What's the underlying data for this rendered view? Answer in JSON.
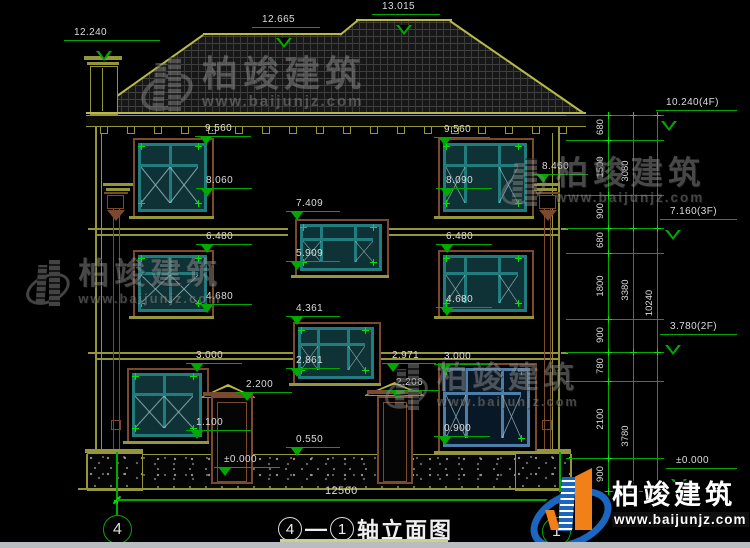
{
  "brand": {
    "name": "柏竣建筑",
    "url": "www.baijunjz.com"
  },
  "colors": {
    "green": "#00a800",
    "bright_green": "#00e400",
    "olive": "#95953a",
    "roof_line": "#b9b94a",
    "brown": "#7b4a2e",
    "teal": "#217d7d",
    "glass": "#0e3236",
    "blue_frame": "#4d7ea8",
    "text": "#dcdcdc",
    "blue": "#1a66c0",
    "orange": "#f28018"
  },
  "title": {
    "axis_start": "4",
    "separator": "—",
    "axis_end": "1",
    "name": "轴立面图"
  },
  "bottom_dim": {
    "value": "12560"
  },
  "axis_bubbles": [
    {
      "label": "4",
      "x": 103,
      "y": 515
    },
    {
      "label": "1",
      "x": 542,
      "y": 517
    }
  ],
  "elevation_markers": [
    {
      "v": "12.240",
      "x": 64,
      "y": 40,
      "w": 96,
      "style": "outline",
      "trx": 32
    },
    {
      "v": "12.665",
      "x": 252,
      "y": 27,
      "w": 68,
      "style": "outline",
      "trx": 24
    },
    {
      "v": "13.015",
      "x": 372,
      "y": 14,
      "w": 68,
      "style": "outline",
      "trx": 24
    },
    {
      "v": "9.560",
      "x": 195,
      "y": 136,
      "w": 56
    },
    {
      "v": "8.060",
      "x": 196,
      "y": 188,
      "w": 56
    },
    {
      "v": "7.409",
      "x": 286,
      "y": 211,
      "w": 54
    },
    {
      "v": "6.480",
      "x": 196,
      "y": 244,
      "w": 56
    },
    {
      "v": "5.909",
      "x": 286,
      "y": 261,
      "w": 54
    },
    {
      "v": "4.680",
      "x": 196,
      "y": 304,
      "w": 56
    },
    {
      "v": "4.361",
      "x": 286,
      "y": 316,
      "w": 54
    },
    {
      "v": "3.000",
      "x": 186,
      "y": 363,
      "w": 56
    },
    {
      "v": "2.861",
      "x": 286,
      "y": 368,
      "w": 54
    },
    {
      "v": "2.200",
      "x": 236,
      "y": 392,
      "w": 56
    },
    {
      "v": "1.100",
      "x": 186,
      "y": 430,
      "w": 66
    },
    {
      "v": "±0.000",
      "x": 214,
      "y": 467,
      "w": 66
    },
    {
      "v": "0.550",
      "x": 286,
      "y": 447,
      "w": 54
    },
    {
      "v": "2.971",
      "x": 382,
      "y": 363,
      "w": 54
    },
    {
      "v": "2.206",
      "x": 386,
      "y": 390,
      "w": 54
    },
    {
      "v": "3.000",
      "x": 434,
      "y": 364,
      "w": 56
    },
    {
      "v": "0.900",
      "x": 434,
      "y": 436,
      "w": 56
    },
    {
      "v": "9.560",
      "x": 434,
      "y": 137,
      "w": 56
    },
    {
      "v": "8.090",
      "x": 436,
      "y": 188,
      "w": 56
    },
    {
      "v": "8.460",
      "x": 532,
      "y": 174,
      "w": 56
    },
    {
      "v": "6.480",
      "x": 436,
      "y": 244,
      "w": 56
    },
    {
      "v": "4.680",
      "x": 436,
      "y": 307,
      "w": 56
    },
    {
      "v": "10.240(4F)",
      "x": 656,
      "y": 110,
      "w": 81,
      "style": "outline"
    },
    {
      "v": "7.160(3F)",
      "x": 660,
      "y": 219,
      "w": 77,
      "style": "outline"
    },
    {
      "v": "3.780(2F)",
      "x": 660,
      "y": 334,
      "w": 77,
      "style": "outline"
    },
    {
      "v": "±0.000",
      "x": 666,
      "y": 468,
      "w": 71,
      "style": "outline"
    }
  ],
  "dim_chain": {
    "line_xs": [
      608,
      633,
      657
    ],
    "ticks_y": [
      115,
      140,
      195,
      228,
      253,
      319,
      352,
      381,
      458,
      491
    ],
    "tick_line": {
      "x1": 566,
      "x2": 664
    },
    "segments": [
      {
        "v": "680",
        "y": 127
      },
      {
        "v": "1500",
        "y": 167
      },
      {
        "v": "900",
        "y": 211
      },
      {
        "v": "680",
        "y": 240
      },
      {
        "v": "1800",
        "y": 286
      },
      {
        "v": "900",
        "y": 335
      },
      {
        "v": "780",
        "y": 366
      },
      {
        "v": "2100",
        "y": 419
      },
      {
        "v": "900",
        "y": 474
      }
    ],
    "subtotals": [
      {
        "v": "3080",
        "y": 171
      },
      {
        "v": "3380",
        "y": 290
      },
      {
        "v": "3780",
        "y": 436
      }
    ],
    "total": [
      {
        "v": "10240",
        "y": 303
      }
    ]
  },
  "gray_watermarks": [
    {
      "x": 140,
      "y": 55,
      "s": 1.0
    },
    {
      "x": 25,
      "y": 258,
      "s": 0.86
    },
    {
      "x": 500,
      "y": 156,
      "s": 0.9
    },
    {
      "x": 384,
      "y": 362,
      "s": 0.85
    }
  ]
}
